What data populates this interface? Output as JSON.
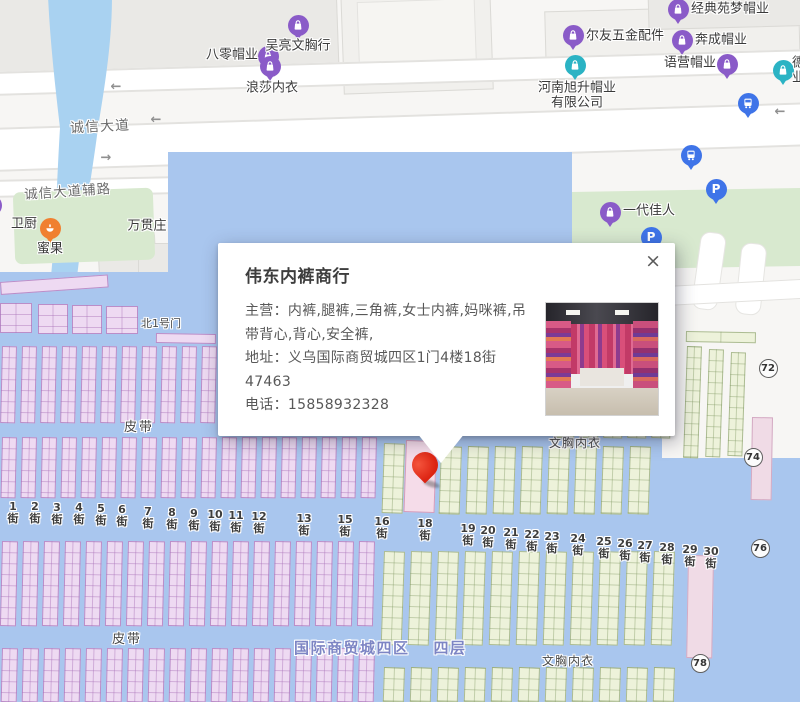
{
  "colors": {
    "pin_red": "#dc2312",
    "poi_purple": "#8a5bc8",
    "poi_teal": "#2bb3c4",
    "transit_blue": "#3f74e8",
    "food_orange": "#f08030",
    "water_blue": "#a9d2f1",
    "floor_blue": "#a9c6ee",
    "stall_pink": "#eedaf2",
    "stall_green": "#edf2da"
  },
  "popup": {
    "title": "伟东内裤商行",
    "close_label": "×",
    "fields": [
      {
        "text": "主营：内裤,腿裤,三角裤,女士内裤,妈咪裤,吊带背心,背心,安全裤,"
      },
      {
        "text": "地址：义乌国际商贸城四区1门4楼18街 47463"
      },
      {
        "text": "电话：15858932328"
      }
    ]
  },
  "map": {
    "road_labels": [
      {
        "text": "诚信大道"
      },
      {
        "text": "诚信大道辅路"
      }
    ],
    "zone_label": {
      "part1": "国际商贸城四区",
      "part2": "四层"
    },
    "area_labels": [
      {
        "text": "北1号门",
        "x": 141,
        "y": 315,
        "fs": 11,
        "ls": 0
      },
      {
        "text": "皮带",
        "x": 124,
        "y": 416,
        "fs": 13,
        "ls": 2
      },
      {
        "text": "文胸内衣",
        "x": 549,
        "y": 434,
        "fs": 12,
        "ls": 1
      },
      {
        "text": "皮带",
        "x": 112,
        "y": 628,
        "fs": 13,
        "ls": 2
      },
      {
        "text": "文胸内衣",
        "x": 542,
        "y": 652,
        "fs": 12,
        "ls": 1
      }
    ],
    "pois": [
      {
        "text": "八零帽业",
        "icon": "bag-purple",
        "ix": 268,
        "iy": 56,
        "lx": 258,
        "ly": 56,
        "align": "right"
      },
      {
        "text": "吴亮文胸行",
        "icon": "bag-purple",
        "ix": 298,
        "iy": 25,
        "lx": 298,
        "ly": 47,
        "align": "center"
      },
      {
        "text": "浪莎内衣",
        "icon": "bag-purple",
        "ix": 270,
        "iy": 66,
        "lx": 272,
        "ly": 89,
        "align": "center"
      },
      {
        "text": "河南旭升帽业",
        "line2": "有限公司",
        "icon": "bag-teal",
        "ix": 575,
        "iy": 65,
        "lx": 577,
        "ly": 96,
        "align": "center"
      },
      {
        "text": "尔友五金配件",
        "icon": "bag-purple",
        "ix": 573,
        "iy": 35,
        "lx": 586,
        "ly": 37,
        "align": "left"
      },
      {
        "text": "经典苑梦帽业",
        "icon": "bag-purple",
        "ix": 678,
        "iy": 9,
        "lx": 691,
        "ly": 10,
        "align": "left"
      },
      {
        "text": "奔成帽业",
        "icon": "bag-purple",
        "ix": 682,
        "iy": 40,
        "lx": 695,
        "ly": 41,
        "align": "left"
      },
      {
        "text": "语营帽业",
        "icon": "bag-purple",
        "ix": 727,
        "iy": 64,
        "lx": 716,
        "ly": 64,
        "align": "right"
      },
      {
        "text": "德",
        "line2": "业",
        "icon": "bag-teal",
        "ix": 783,
        "iy": 70,
        "lx": 792,
        "ly": 71,
        "align": "left"
      },
      {
        "text": "一代佳人",
        "icon": "bag-purple",
        "ix": 610,
        "iy": 212,
        "lx": 623,
        "ly": 212,
        "align": "left"
      },
      {
        "text": "蜜果",
        "icon": "food-orange",
        "ix": 50,
        "iy": 228,
        "lx": 50,
        "ly": 250,
        "align": "center"
      },
      {
        "text": "卫厨",
        "icon": "bag-purple",
        "ix": -9,
        "iy": 205,
        "lx": 24,
        "ly": 225,
        "align": "center"
      },
      {
        "text": "万贯庄",
        "icon": "none",
        "ix": 0,
        "iy": 0,
        "lx": 147,
        "ly": 227,
        "align": "center"
      },
      {
        "text": "",
        "icon": "bus-blue",
        "ix": 748,
        "iy": 103,
        "lx": 0,
        "ly": 0,
        "align": "center"
      },
      {
        "text": "",
        "icon": "bus-blue",
        "ix": 691,
        "iy": 155,
        "lx": 0,
        "ly": 0,
        "align": "center"
      },
      {
        "text": "",
        "icon": "parking-blue",
        "ix": 716,
        "iy": 189,
        "lx": 0,
        "ly": 0,
        "align": "center"
      },
      {
        "text": "",
        "icon": "parking-blue",
        "ix": 651,
        "iy": 237,
        "lx": 0,
        "ly": 0,
        "align": "center"
      }
    ],
    "parking_letter": "P",
    "streets": [
      {
        "label": "1街",
        "x": 4,
        "y": 501
      },
      {
        "label": "2街",
        "x": 26,
        "y": 501
      },
      {
        "label": "3街",
        "x": 48,
        "y": 502
      },
      {
        "label": "4街",
        "x": 70,
        "y": 502
      },
      {
        "label": "5街",
        "x": 92,
        "y": 503
      },
      {
        "label": "6街",
        "x": 113,
        "y": 504
      },
      {
        "label": "7街",
        "x": 139,
        "y": 506
      },
      {
        "label": "8街",
        "x": 163,
        "y": 507
      },
      {
        "label": "9街",
        "x": 185,
        "y": 508
      },
      {
        "label": "10街",
        "x": 206,
        "y": 509
      },
      {
        "label": "11街",
        "x": 227,
        "y": 510
      },
      {
        "label": "12街",
        "x": 250,
        "y": 511
      },
      {
        "label": "13街",
        "x": 295,
        "y": 513
      },
      {
        "label": "15街",
        "x": 336,
        "y": 514
      },
      {
        "label": "16街",
        "x": 373,
        "y": 516
      },
      {
        "label": "18街",
        "x": 416,
        "y": 518
      },
      {
        "label": "19街",
        "x": 459,
        "y": 523
      },
      {
        "label": "20街",
        "x": 479,
        "y": 525
      },
      {
        "label": "21街",
        "x": 502,
        "y": 527
      },
      {
        "label": "22街",
        "x": 523,
        "y": 529
      },
      {
        "label": "23街",
        "x": 543,
        "y": 531
      },
      {
        "label": "24街",
        "x": 569,
        "y": 533
      },
      {
        "label": "25街",
        "x": 595,
        "y": 536
      },
      {
        "label": "26街",
        "x": 616,
        "y": 538
      },
      {
        "label": "27街",
        "x": 636,
        "y": 540
      },
      {
        "label": "28街",
        "x": 658,
        "y": 542
      },
      {
        "label": "29街",
        "x": 681,
        "y": 544
      },
      {
        "label": "30街",
        "x": 702,
        "y": 546
      }
    ],
    "badges": [
      {
        "n": "72",
        "x": 768,
        "y": 368
      },
      {
        "n": "74",
        "x": 753,
        "y": 457
      },
      {
        "n": "76",
        "x": 760,
        "y": 548
      },
      {
        "n": "78",
        "x": 700,
        "y": 663
      }
    ],
    "arrows": [
      {
        "sym": "←",
        "x": 116,
        "y": 87
      },
      {
        "sym": "←",
        "x": 156,
        "y": 120
      },
      {
        "sym": "→",
        "x": 106,
        "y": 158
      },
      {
        "sym": "←",
        "x": 780,
        "y": 112
      }
    ]
  }
}
